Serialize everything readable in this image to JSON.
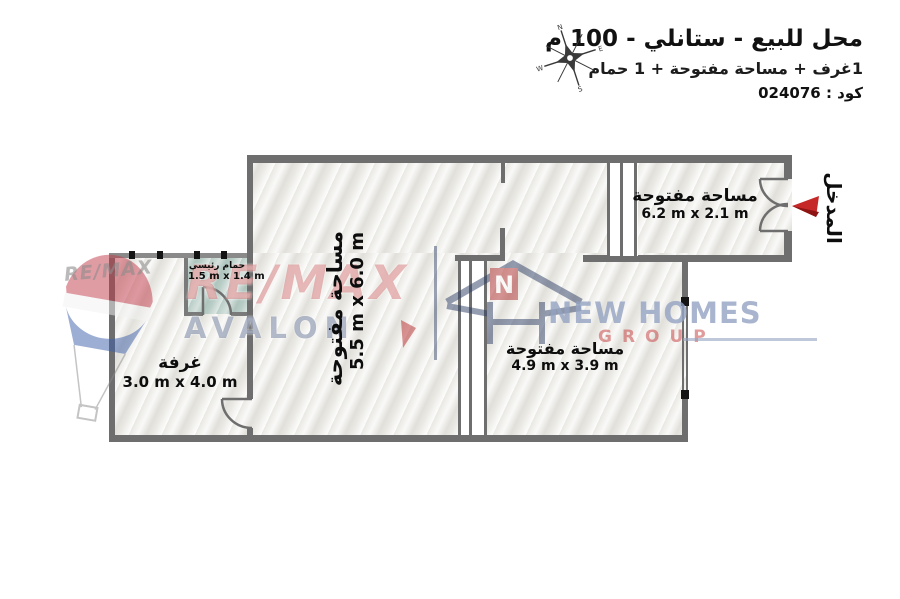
{
  "header": {
    "title": "محل للبيع - ستانلي - 100 م",
    "subtitle": "1غرف + مساحة مفتوحة + 1 حمام",
    "code": "كود : 024076",
    "compass": {
      "n": "N",
      "e": "E",
      "s": "S",
      "w": "W"
    }
  },
  "rooms": {
    "open_top": {
      "name": "مساحة مفتوحة",
      "dims": "6.2 m x 2.1 m"
    },
    "open_center": {
      "name": "مساحة مفتوحة",
      "dims": "5.5 m x 6.0 m"
    },
    "open_bottom": {
      "name": "مساحة مفتوحة",
      "dims": "4.9 m x 3.9 m"
    },
    "bedroom": {
      "name": "غرفة",
      "dims": "3.0 m x 4.0 m"
    },
    "bathroom": {
      "name": "حمام رئيسي",
      "dims": "1.5 m x 1.4 m"
    }
  },
  "entrance": {
    "label": "المدخل"
  },
  "watermarks": {
    "remax_small": "RE/MAX",
    "remax_big": "RE/MAX",
    "remax_sub": "AVALON",
    "newhomes_initial": "N",
    "newhomes_brand": "NEW HOMES",
    "newhomes_sub": "GROUP"
  },
  "colors": {
    "wall": "#6e6e6e",
    "window_cap": "#141414",
    "bathroom_fill": "#b9cdc7",
    "entrance_arrow": "#c62828",
    "remax_red": "#ba2c2c",
    "avalon_blue": "#495d82",
    "newhomes_blue": "#94a3c2",
    "group_red": "#c94848"
  }
}
